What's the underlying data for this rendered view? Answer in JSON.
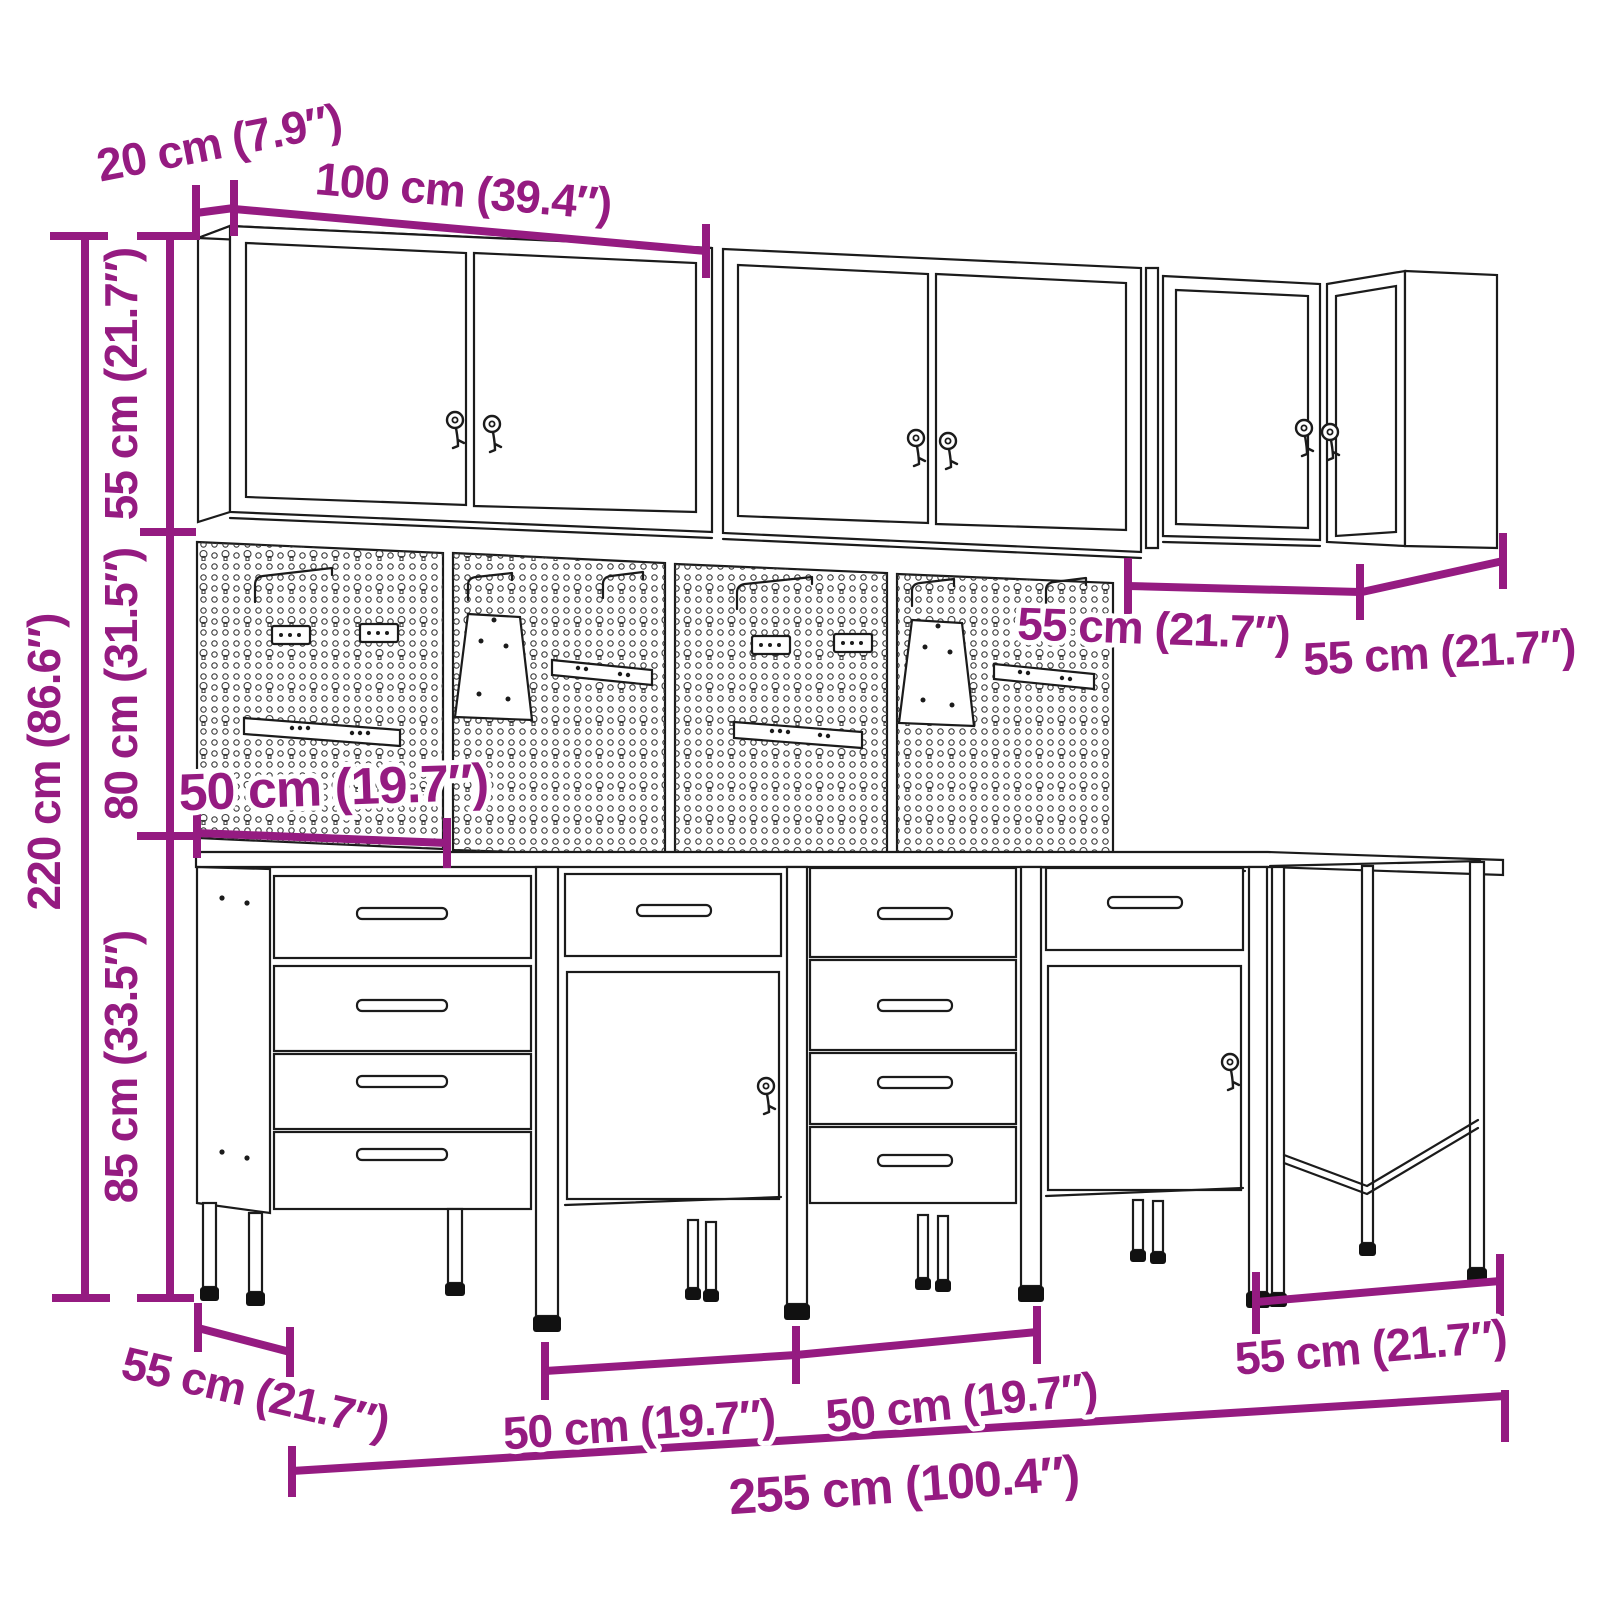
{
  "drawing": {
    "kind": "product-dimension-diagram",
    "subject": "workshop cabinet set with wall cabinets, pegboards, drawer cabinets and worktable",
    "accent_color": "#951B81",
    "line_color": "#1b1b1b",
    "background_color": "#ffffff"
  },
  "dims": {
    "wall_depth": {
      "label": "20 cm (7.9″)",
      "value_cm": 20,
      "value_in": 7.9
    },
    "wall_width": {
      "label": "100 cm (39.4″)",
      "value_cm": 100,
      "value_in": 39.4
    },
    "wall_height": {
      "label": "55 cm (21.7″)",
      "value_cm": 55,
      "value_in": 21.7
    },
    "pegboard_height": {
      "label": "80 cm (31.5″)",
      "value_cm": 80,
      "value_in": 31.5
    },
    "total_height": {
      "label": "220 cm (86.6″)",
      "value_cm": 220,
      "value_in": 86.6
    },
    "base_height": {
      "label": "85 cm (33.5″)",
      "value_cm": 85,
      "value_in": 33.5
    },
    "corner_front": {
      "label": "55 cm (21.7″)",
      "value_cm": 55,
      "value_in": 21.7
    },
    "corner_side": {
      "label": "55 cm (21.7″)",
      "value_cm": 55,
      "value_in": 21.7
    },
    "pegboard_width": {
      "label": "50 cm (19.7″)",
      "value_cm": 50,
      "value_in": 19.7
    },
    "base_depth": {
      "label": "55 cm (21.7″)",
      "value_cm": 55,
      "value_in": 21.7
    },
    "base_unit1": {
      "label": "50 cm (19.7″)",
      "value_cm": 50,
      "value_in": 19.7
    },
    "base_unit2": {
      "label": "50 cm (19.7″)",
      "value_cm": 50,
      "value_in": 19.7
    },
    "table_width": {
      "label": "55 cm (21.7″)",
      "value_cm": 55,
      "value_in": 21.7
    },
    "total_width": {
      "label": "255 cm (100.4″)",
      "value_cm": 255,
      "value_in": 100.4
    }
  }
}
